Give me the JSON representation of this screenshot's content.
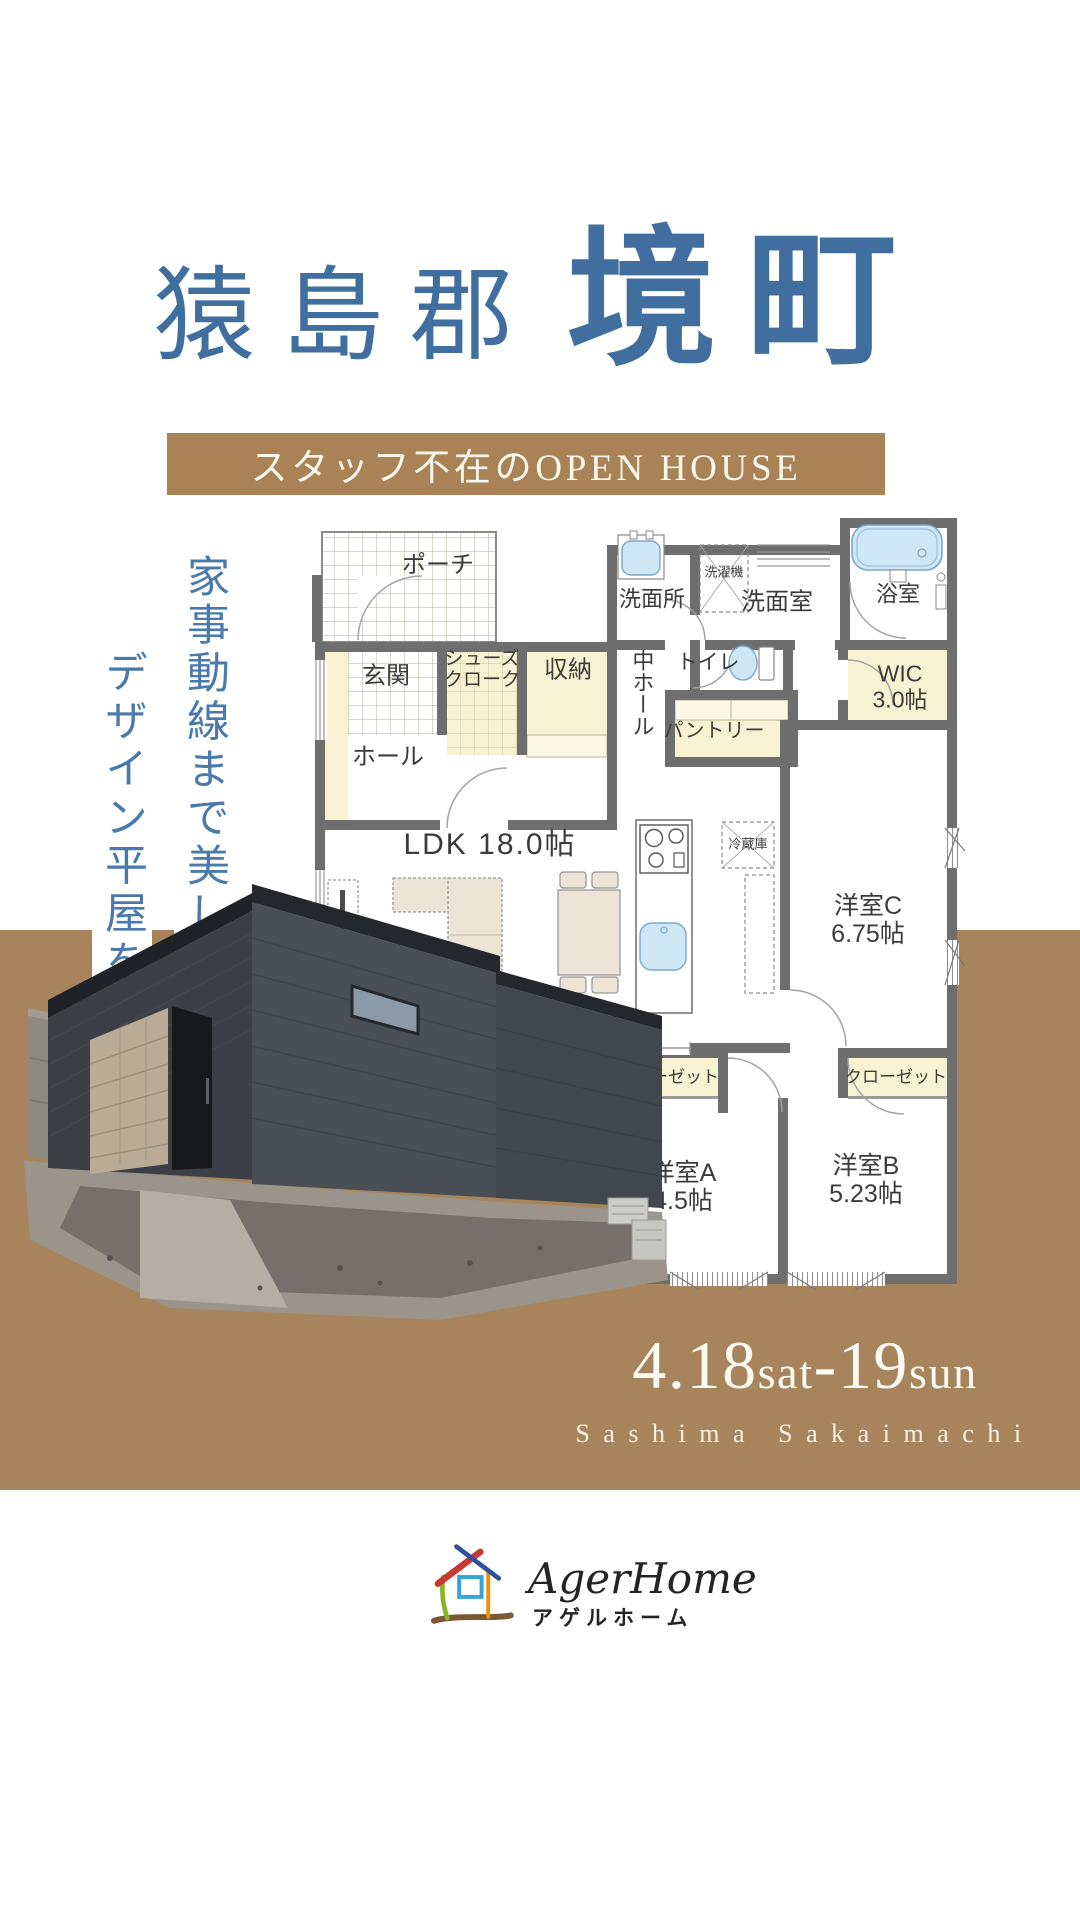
{
  "title": {
    "district": "猿島郡",
    "town": "境町"
  },
  "banner": {
    "label": "スタッフ不在のOPEN HOUSE"
  },
  "tagline": {
    "line1": "家事動線まで美しい、",
    "line2": "デザイン平屋を体感"
  },
  "floorplan": {
    "porch": "ポーチ",
    "entrance": "玄関",
    "shoe_closet_line1": "シューズ",
    "shoe_closet_line2": "クローク",
    "storage": "収納",
    "hall": "ホール",
    "washroom": "洗面所",
    "washer": "洗濯機",
    "powder_room": "洗面室",
    "bathroom": "浴室",
    "toilet": "トイレ",
    "middle_hall": "中ホール",
    "pantry": "パントリー",
    "wic_line1": "WIC",
    "wic_line2": "3.0帖",
    "ldk": "LDK 18.0帖",
    "fridge": "冷蔵庫",
    "room_c_line1": "洋室C",
    "room_c_line2": "6.75帖",
    "closet_a": "クローゼット",
    "closet_b": "クローゼット",
    "room_a_line1": "洋室A",
    "room_a_line2": "4.5帖",
    "room_b_line1": "洋室B",
    "room_b_line2": "5.23帖"
  },
  "event": {
    "date_start": "4.18",
    "day_start": "sat",
    "dash": "-",
    "date_end": "19",
    "day_end": "sun",
    "location_romaji": "Sashima Sakaimachi"
  },
  "logo": {
    "latin": "AgerHome",
    "kana": "アゲルホーム"
  },
  "colors": {
    "brand_blue": "#406e9e",
    "accent_brown": "#a8845c",
    "banner_brown": "#a98355",
    "wall_gray": "#6e6e6e",
    "room_yellow": "#f6f2d2",
    "fixture_blue": "#cfe6f4"
  }
}
